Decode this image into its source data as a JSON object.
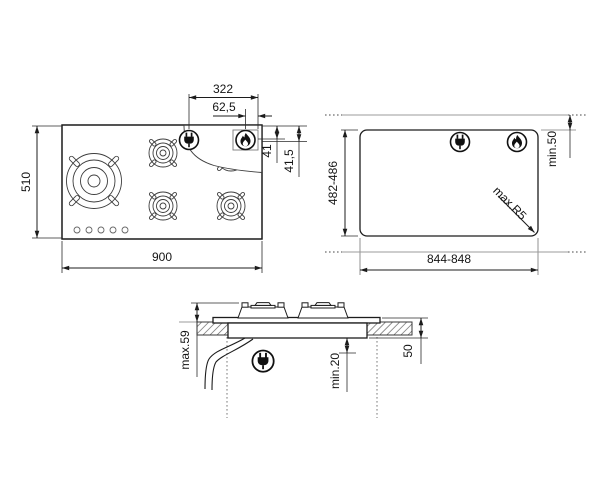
{
  "colors": {
    "background": "#ffffff",
    "drawing_line": "#1c1c1c",
    "reference_line": "#9b9b9b",
    "text": "#141414"
  },
  "top_view": {
    "width": "900",
    "depth": "510",
    "plug_offset_from_right": "322",
    "flame_offset_from_right": "62,5",
    "flame_offset_from_top": "41",
    "plug_offset_from_top": "41,5",
    "burner_count": 5,
    "knob_count": 5
  },
  "cutout_view": {
    "width": "844-848",
    "depth": "482-486",
    "rear_clearance": "min.50",
    "corner_radius": "max.R5"
  },
  "section_view": {
    "height_above_worktop": "max.59",
    "clearance_below_hob": "min.20",
    "recess_depth": "50"
  },
  "icons": {
    "plug": "power-plug-icon",
    "flame": "gas-flame-icon"
  }
}
